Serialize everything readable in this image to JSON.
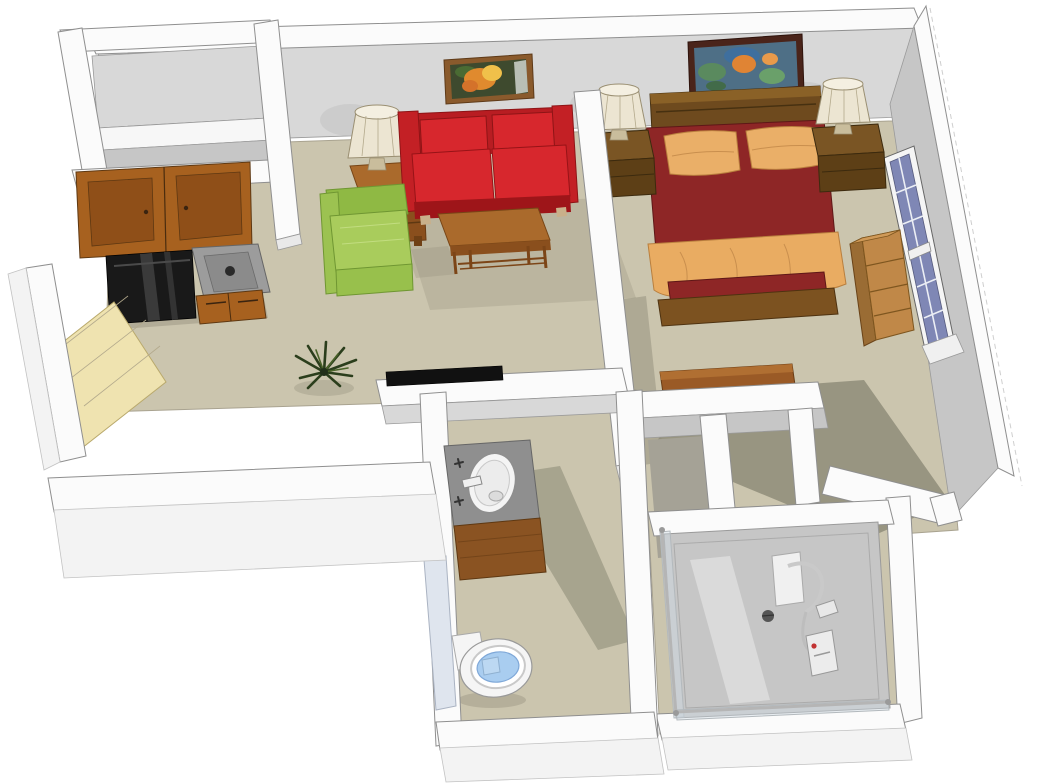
{
  "meta": {
    "kind": "3d-isometric-floor-plan-render",
    "subject": "studio apartment with kitchen, living area, bedroom, bathroom and shower room",
    "background": "#ffffff"
  },
  "colors": {
    "floor": "#cbc5ae",
    "floor_shadow": "#8b8875",
    "wall_top": "#fbfbfb",
    "wall_face": "#d8d8d8",
    "wall_face_dark": "#c6c6c6",
    "closet_interior": "#a5a296",
    "sofa_red": "#d7272d",
    "sofa_red_dark": "#b81d22",
    "sofa_red_deep": "#9e1519",
    "chair_green": "#a9cc5c",
    "chair_green_dark": "#8fb944",
    "chair_green_mid": "#98c04c",
    "wood_table": "#aa6a2c",
    "wood_table_dark": "#8a4f1d",
    "cabinet_wood": "#a7611f",
    "cabinet_panel": "#8f4f18",
    "counter_gray": "#9c9c9c",
    "appliance_black": "#191919",
    "entry_door": "#efe3b0",
    "bed_spread": "#8e2626",
    "bed_blanket": "#e9ac62",
    "bed_pillow": "#eaaf68",
    "bed_frame_wood": "#7c5220",
    "headboard_wood": "#6e4a1e",
    "nightstand_wood": "#5d3f16",
    "nightstand_top": "#7a5524",
    "lamp_shade": "#ece5d2",
    "lamp_base": "#c9bd9c",
    "window_glass": "#7f87b5",
    "window_frame": "#f5f5f5",
    "bookshelf_wood": "#c08848",
    "dresser_wood": "#9a5a26",
    "vanity_counter": "#8f8f8f",
    "vanity_wood": "#8a5322",
    "sink_white": "#f4f4f4",
    "toilet_white": "#f5f5f5",
    "toilet_seat_blue": "#a9cdf0",
    "shower_floor": "#c6c6c6",
    "plant_green": "#2b3e1c",
    "tv_black": "#111111",
    "art_frame_living": "#8a5a2c",
    "art_frame_bedroom": "#4a241a",
    "bath_door_panel": "#dfe5ee"
  },
  "rooms": [
    {
      "id": "entry-kitchen",
      "items": [
        "entry-door",
        "upper-cabinets",
        "range",
        "counter-sink",
        "base-cabinets",
        "closet-shelf"
      ]
    },
    {
      "id": "living-area",
      "items": [
        "red-loveseat",
        "green-armchair",
        "coffee-table",
        "side-table",
        "table-lamp",
        "flower-painting",
        "floor-plant",
        "wall-tv"
      ]
    },
    {
      "id": "bedroom",
      "items": [
        "double-bed",
        "headboard",
        "pillows",
        "blanket",
        "nightstand-left",
        "nightstand-right",
        "bedside-lamp-left",
        "bedside-lamp-right",
        "impressionist-painting",
        "window",
        "bookshelf",
        "dresser"
      ]
    },
    {
      "id": "bathroom",
      "items": [
        "vanity-sink",
        "toilet",
        "door-panel"
      ]
    },
    {
      "id": "shower-room",
      "items": [
        "shower-stall",
        "shower-fixture",
        "floor-drain"
      ]
    }
  ]
}
